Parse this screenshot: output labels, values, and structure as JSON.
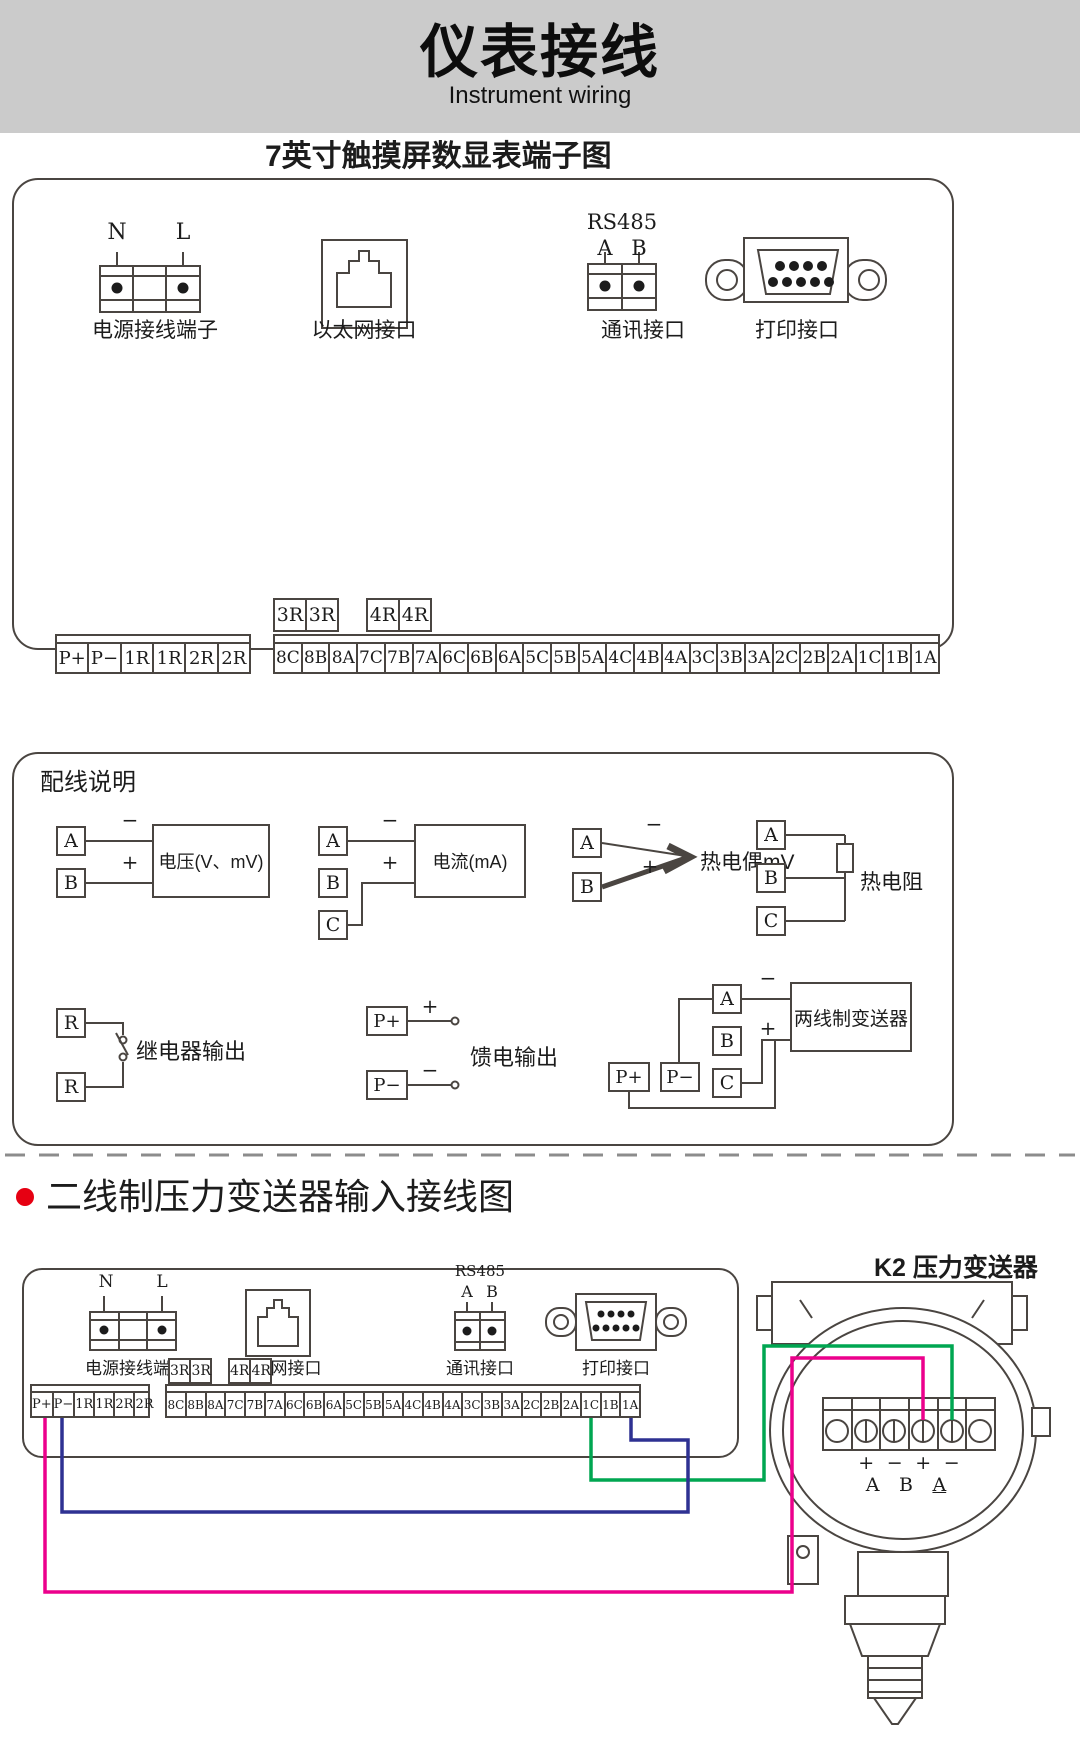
{
  "banner": {
    "title": "仪表接线",
    "subtitle": "Instrument wiring"
  },
  "section1": {
    "heading": "7英寸触摸屏数显表端子图",
    "power": {
      "label": "电源接线端子",
      "pin1": "N",
      "pin2": "L"
    },
    "ethernet": {
      "label": "以太网接口"
    },
    "comm": {
      "label": "通讯接口",
      "bus": "RS485",
      "pin1": "A",
      "pin2": "B"
    },
    "print": {
      "label": "打印接口"
    },
    "relay34": [
      "3R",
      "3R"
    ],
    "relay44": [
      "4R",
      "4R"
    ],
    "left_terminals": [
      "P+",
      "P−",
      "1R",
      "1R",
      "2R",
      "2R"
    ],
    "right_terminals": [
      "8C",
      "8B",
      "8A",
      "7C",
      "7B",
      "7A",
      "6C",
      "6B",
      "6A",
      "5C",
      "5B",
      "5A",
      "4C",
      "4B",
      "4A",
      "3C",
      "3B",
      "3A",
      "2C",
      "2B",
      "2A",
      "1C",
      "1B",
      "1A"
    ]
  },
  "section2": {
    "heading": "配线说明",
    "signs": {
      "plus": "+",
      "minus": "−"
    },
    "voltage": {
      "a": "A",
      "b": "B",
      "label": "电压(V、mV)"
    },
    "current": {
      "a": "A",
      "b": "B",
      "c": "C",
      "label": "电流(mA)"
    },
    "thermocouple": {
      "a": "A",
      "b": "B",
      "label": "热电偶mV"
    },
    "rtd": {
      "a": "A",
      "b": "B",
      "c": "C",
      "label": "热电阻"
    },
    "relay": {
      "r1": "R",
      "r2": "R",
      "label": "继电器输出"
    },
    "feed": {
      "pplus": "P+",
      "pminus": "P−",
      "label": "馈电输出"
    },
    "two_wire": {
      "a": "A",
      "b": "B",
      "c": "C",
      "pplus": "P+",
      "pminus": "P−",
      "label": "两线制变送器"
    }
  },
  "section3": {
    "heading": "二线制压力变送器输入接线图",
    "device_label": "K2 压力变送器",
    "power": {
      "label": "电源接线端子",
      "pin1": "N",
      "pin2": "L"
    },
    "ethernet": {
      "label": "以太网接口"
    },
    "comm": {
      "label": "通讯接口",
      "bus": "RS485",
      "pin1": "A",
      "pin2": "B"
    },
    "print": {
      "label": "打印接口"
    },
    "relay34": [
      "3R",
      "3R"
    ],
    "relay44": [
      "4R",
      "4R"
    ],
    "left_terminals": [
      "P+",
      "P−",
      "1R",
      "1R",
      "2R",
      "2R"
    ],
    "right_terminals": [
      "8C",
      "8B",
      "8A",
      "7C",
      "7B",
      "7A",
      "6C",
      "6B",
      "6A",
      "5C",
      "5B",
      "5A",
      "4C",
      "4B",
      "4A",
      "3C",
      "3B",
      "3A",
      "2C",
      "2B",
      "2A",
      "1C",
      "1B",
      "1A"
    ],
    "transmitter": {
      "signs": [
        "+",
        "−",
        "+",
        "−"
      ],
      "letters": [
        "A",
        "B",
        "A"
      ]
    }
  },
  "colors": {
    "wire_green": "#00A651",
    "wire_pink": "#EC008C",
    "wire_blue": "#2E3192",
    "bullet_red": "#E60012",
    "banner_gray": "#CBCBCB",
    "line": "#4A4541"
  }
}
